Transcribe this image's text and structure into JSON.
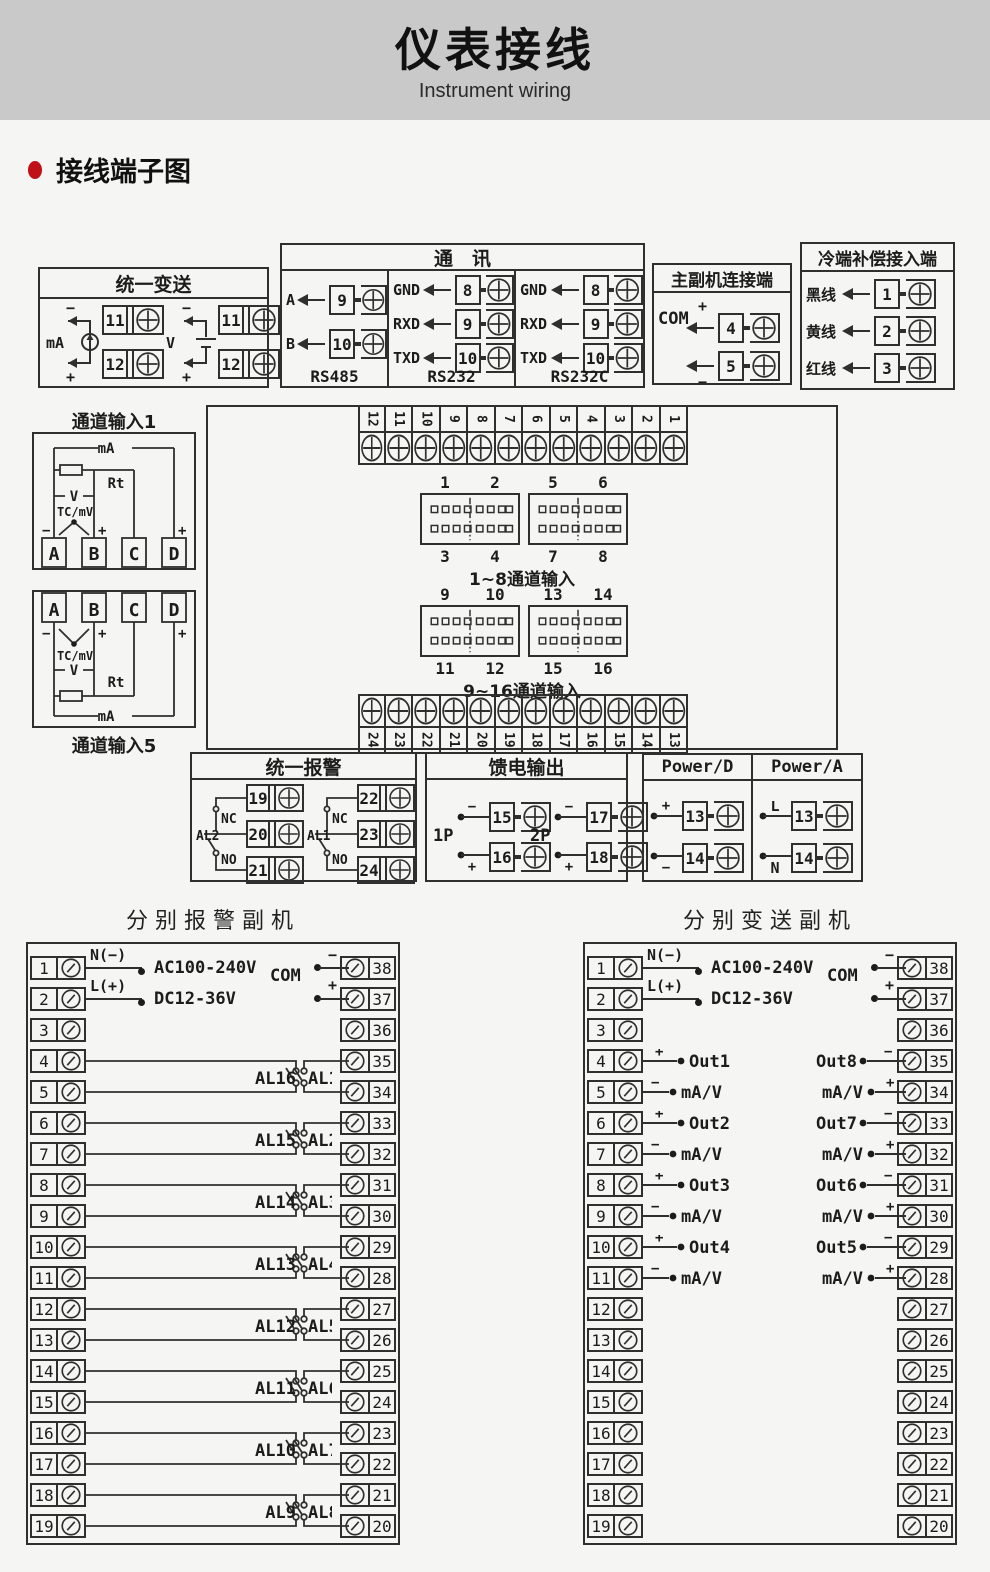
{
  "header": {
    "title": "仪表接线",
    "subtitle": "Instrument wiring"
  },
  "section": {
    "label": "接线端子图"
  },
  "transmit_box": {
    "title": "统一变送",
    "groups": [
      {
        "label": "mA",
        "minus": "−",
        "plus": "+",
        "terms": [
          "11",
          "12"
        ]
      },
      {
        "label": "V",
        "minus": "−",
        "plus": "+",
        "terms": [
          "11",
          "12"
        ]
      }
    ]
  },
  "comm_box": {
    "title": "通　讯",
    "columns": [
      {
        "name": "RS485",
        "rows": [
          {
            "label": "A",
            "num": "9"
          },
          {
            "label": "B",
            "num": "10"
          }
        ]
      },
      {
        "name": "RS232",
        "rows": [
          {
            "label": "GND",
            "num": "8"
          },
          {
            "label": "RXD",
            "num": "9"
          },
          {
            "label": "TXD",
            "num": "10"
          }
        ]
      },
      {
        "name": "RS232C",
        "rows": [
          {
            "label": "GND",
            "num": "8"
          },
          {
            "label": "RXD",
            "num": "9"
          },
          {
            "label": "TXD",
            "num": "10"
          }
        ]
      }
    ]
  },
  "master_box": {
    "title": "主副机连接端",
    "com": "COM",
    "rows": [
      {
        "sign": "+",
        "num": "4"
      },
      {
        "sign": "−",
        "num": "5"
      }
    ]
  },
  "cold_box": {
    "title": "冷端补偿接入端",
    "rows": [
      {
        "label": "黑线",
        "num": "1"
      },
      {
        "label": "黄线",
        "num": "2"
      },
      {
        "label": "红线",
        "num": "3"
      }
    ]
  },
  "main_box": {
    "top_terms": [
      "12",
      "11",
      "10",
      "9",
      "8",
      "7",
      "6",
      "5",
      "4",
      "3",
      "2",
      "1"
    ],
    "bottom_terms": [
      "24",
      "23",
      "22",
      "21",
      "20",
      "19",
      "18",
      "17",
      "16",
      "15",
      "14",
      "13"
    ],
    "groupA": {
      "top_labels": [
        "1",
        "2",
        "5",
        "6"
      ],
      "bottom_labels": [
        "3",
        "4",
        "7",
        "8"
      ],
      "caption": "1~8通道输入"
    },
    "groupB": {
      "top_labels": [
        "9",
        "10",
        "13",
        "14"
      ],
      "bottom_labels": [
        "11",
        "12",
        "15",
        "16"
      ],
      "caption": "9~16通道输入"
    }
  },
  "ch1_box": {
    "label": "通道输入1",
    "ma": "mA",
    "rt": "Rt",
    "v": "V",
    "tc": "TC/mV",
    "minus": "−",
    "plus_b": "+",
    "plus_d": "+",
    "terms": [
      "A",
      "B",
      "C",
      "D"
    ]
  },
  "ch5_box": {
    "label": "通道输入5",
    "ma": "mA",
    "rt": "Rt",
    "v": "V",
    "tc": "TC/mV",
    "minus": "−",
    "plus_b": "+",
    "plus_d": "+",
    "terms": [
      "A",
      "B",
      "C",
      "D"
    ]
  },
  "alarm_box": {
    "title": "统一报警",
    "groups": [
      {
        "label": "AL2",
        "nc": "NC",
        "no": "NO",
        "terms": [
          "19",
          "20",
          "21"
        ]
      },
      {
        "label": "AL1",
        "nc": "NC",
        "no": "NO",
        "terms": [
          "22",
          "23",
          "24"
        ]
      }
    ]
  },
  "feed_box": {
    "title": "馈电输出",
    "groups": [
      {
        "label": "1P",
        "rows": [
          {
            "sign": "−",
            "num": "15"
          },
          {
            "sign": "+",
            "num": "16"
          }
        ]
      },
      {
        "label": "2P",
        "rows": [
          {
            "sign": "−",
            "num": "17"
          },
          {
            "sign": "+",
            "num": "18"
          }
        ]
      }
    ]
  },
  "power_boxes": [
    {
      "title": "Power/D",
      "rows": [
        {
          "sign": "+",
          "num": "13"
        },
        {
          "sign": "−",
          "num": "14"
        }
      ]
    },
    {
      "title": "Power/A",
      "rows": [
        {
          "sign": "L",
          "num": "13"
        },
        {
          "sign": "N",
          "num": "14"
        }
      ]
    }
  ],
  "alarm_slave": {
    "title": "分别报警副机",
    "left_terms": [
      "1",
      "2",
      "3",
      "4",
      "5",
      "6",
      "7",
      "8",
      "9",
      "10",
      "11",
      "12",
      "13",
      "14",
      "15",
      "16",
      "17",
      "18",
      "19"
    ],
    "right_terms": [
      "38",
      "37",
      "36",
      "35",
      "34",
      "33",
      "32",
      "31",
      "30",
      "29",
      "28",
      "27",
      "26",
      "25",
      "24",
      "23",
      "22",
      "21",
      "20"
    ],
    "power": {
      "n": "N(−)",
      "l": "L(+)",
      "ac": "AC100-240V",
      "dc": "DC12-36V",
      "com": "COM",
      "minus": "−",
      "plus": "+"
    },
    "left_groups": [
      "AL1",
      "AL2",
      "AL3",
      "AL4",
      "AL5",
      "AL6",
      "AL7",
      "AL8"
    ],
    "right_groups": [
      "AL16",
      "AL15",
      "AL14",
      "AL13",
      "AL12",
      "AL11",
      "AL10",
      "AL9"
    ]
  },
  "transmit_slave": {
    "title": "分别变送副机",
    "left_terms": [
      "1",
      "2",
      "3",
      "4",
      "5",
      "6",
      "7",
      "8",
      "9",
      "10",
      "11",
      "12",
      "13",
      "14",
      "15",
      "16",
      "17",
      "18",
      "19"
    ],
    "right_terms": [
      "38",
      "37",
      "36",
      "35",
      "34",
      "33",
      "32",
      "31",
      "30",
      "29",
      "28",
      "27",
      "26",
      "25",
      "24",
      "23",
      "22",
      "21",
      "20"
    ],
    "power": {
      "n": "N(−)",
      "l": "L(+)",
      "ac": "AC100-240V",
      "dc": "DC12-36V",
      "com": "COM",
      "minus": "−",
      "plus": "+"
    },
    "left_groups": [
      {
        "plus": "+",
        "minus": "−",
        "out": "Out1",
        "unit": "mA/V"
      },
      {
        "plus": "+",
        "minus": "−",
        "out": "Out2",
        "unit": "mA/V"
      },
      {
        "plus": "+",
        "minus": "−",
        "out": "Out3",
        "unit": "mA/V"
      },
      {
        "plus": "+",
        "minus": "−",
        "out": "Out4",
        "unit": "mA/V"
      }
    ],
    "right_groups": [
      {
        "minus": "−",
        "plus": "+",
        "out": "Out8",
        "unit": "mA/V"
      },
      {
        "minus": "−",
        "plus": "+",
        "out": "Out7",
        "unit": "mA/V"
      },
      {
        "minus": "−",
        "plus": "+",
        "out": "Out6",
        "unit": "mA/V"
      },
      {
        "minus": "−",
        "plus": "+",
        "out": "Out5",
        "unit": "mA/V"
      }
    ]
  }
}
